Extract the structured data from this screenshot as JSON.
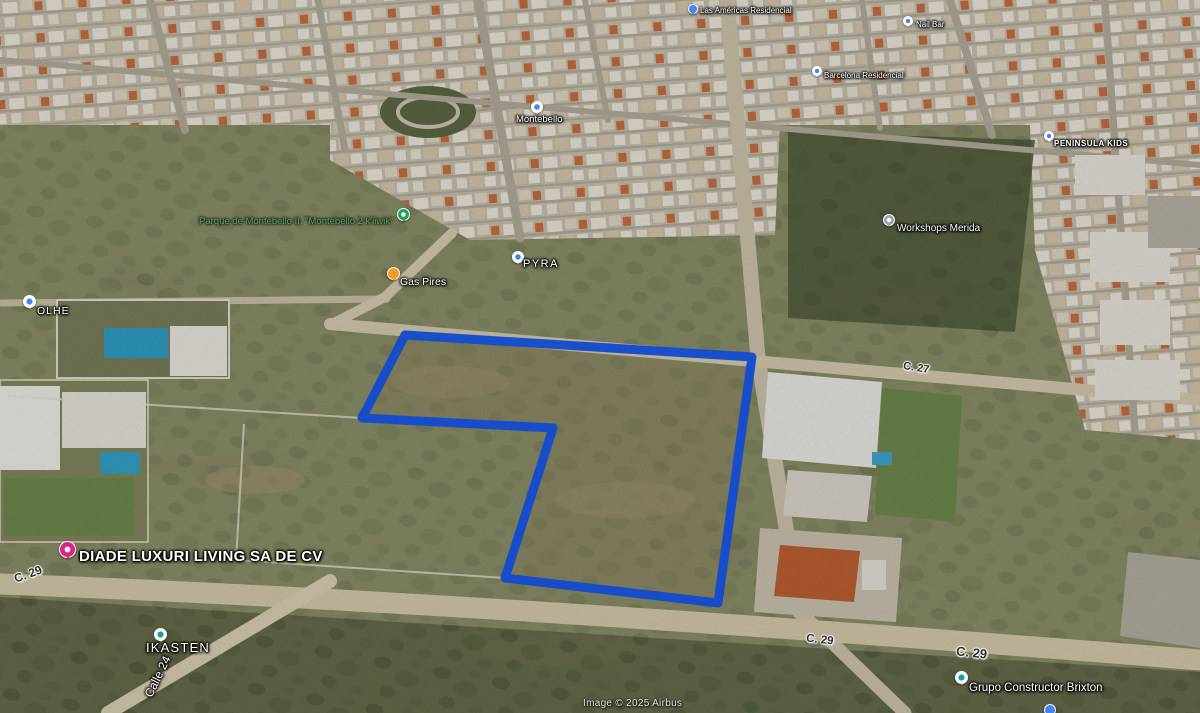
{
  "map": {
    "kind": "aerial-oblique-satellite-view",
    "accent_color": "#1657f0",
    "labels": {
      "top_business": {
        "text": "Las Américas Residencial"
      },
      "nail_bar": {
        "text": "Nail Bar"
      },
      "residencial": {
        "text": "Barcelona Residencial"
      },
      "peninsula_kids": {
        "text": "PENINSULA KIDS"
      },
      "montebello": {
        "text": "Montebello"
      },
      "park": {
        "text": "Parque de Montebello II. \"Montebello 2 k'iiwik\""
      },
      "pyra": {
        "text": "PYRA"
      },
      "gas_pires": {
        "text": "Gas Pires"
      },
      "olhe": {
        "text": "OLHE"
      },
      "workshops": {
        "text": "Workshops Merida"
      },
      "street_c27": {
        "text": "C. 27"
      },
      "diade": {
        "text": "DIADE LUXURI LIVING SA DE CV"
      },
      "street_c29_left": {
        "text": "C. 29"
      },
      "ikasten": {
        "text": "IKASTEN"
      },
      "street_calle24": {
        "text": "Calle 24"
      },
      "street_c29_mid": {
        "text": "C. 29"
      },
      "street_c29_right": {
        "text": "C. 29"
      },
      "brixton": {
        "text": "Grupo Constructor Brixton"
      }
    },
    "polygon": {
      "points": "405,335 752,357 718,603 505,578 553,428 362,418",
      "stroke": "#1657f0",
      "stroke_width": 9
    },
    "attribution": {
      "text": "Image © 2025 Airbus"
    }
  }
}
